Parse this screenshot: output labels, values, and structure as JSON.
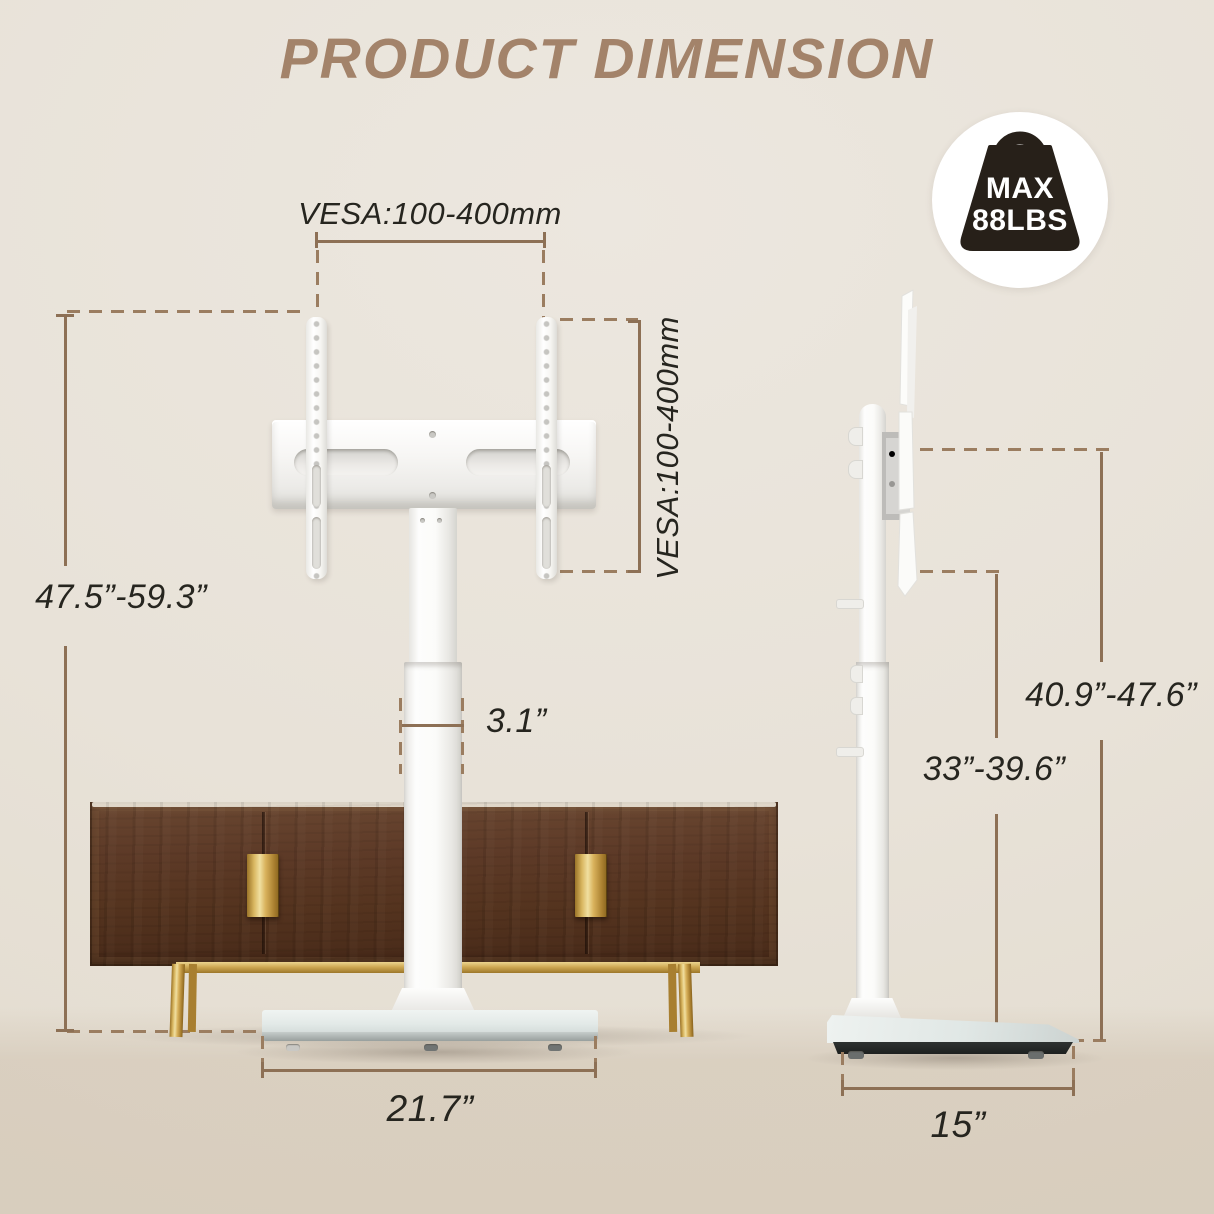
{
  "title": "PRODUCT DIMENSION",
  "badge": {
    "line1": "MAX",
    "line2": "88LBS",
    "icon": "weight-bag-icon"
  },
  "front_view": {
    "vesa_width_label": "VESA:100-400mm",
    "vesa_height_label": "VESA:100-400mm",
    "stand_height_range": "47.5”-59.3”",
    "pole_width": "3.1”",
    "base_width": "21.7”"
  },
  "side_view": {
    "upper_height_range": "40.9”-47.6”",
    "lower_height_range": "33”-39.6”",
    "base_depth": "15”"
  },
  "colors": {
    "title_brown": "#a3836a",
    "dimension_line": "#8d7055",
    "dash_line": "#9b7d60",
    "label_text": "#26251f",
    "stand_white": "#fbfbf9",
    "cabinet_wood": "#5d3a27",
    "cabinet_gold": "#cfa954",
    "base_glass": "#e4ebe9",
    "background": "#e8e2d8"
  }
}
